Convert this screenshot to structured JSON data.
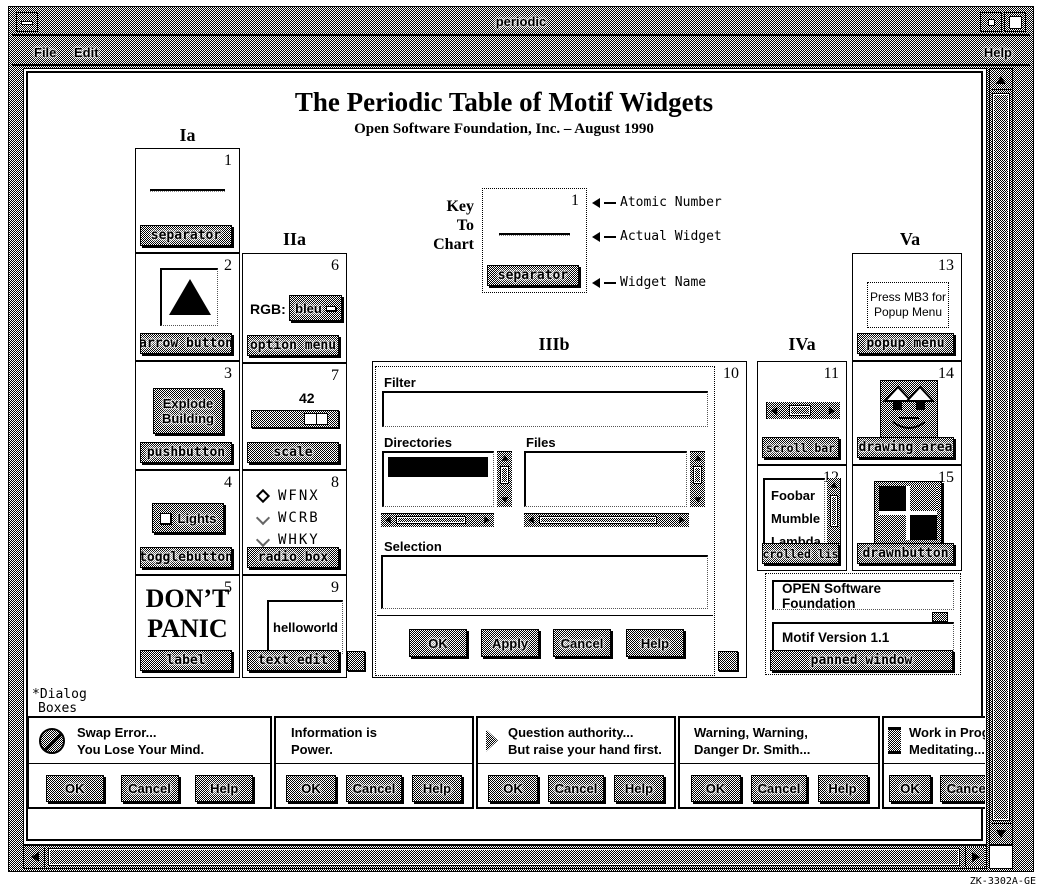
{
  "colors": {
    "foreground": "#000000",
    "background": "#ffffff"
  },
  "window": {
    "title": "periodic",
    "menus": {
      "file": "File",
      "edit": "Edit",
      "help": "Help"
    }
  },
  "header": {
    "title": "The Periodic Table of Motif Widgets",
    "subtitle": "Open Software Foundation, Inc. – August 1990"
  },
  "column_headers": {
    "ia": "Ia",
    "iia": "IIa",
    "iiib": "IIIb",
    "iva": "IVa",
    "va": "Va"
  },
  "key": {
    "label_line1": "Key",
    "label_line2": "To",
    "label_line3": "Chart",
    "number": "1",
    "widget_name": "separator",
    "annotations": {
      "number": "Atomic Number",
      "widget": "Actual Widget",
      "name": "Widget Name"
    }
  },
  "cells": {
    "separator": {
      "number": "1",
      "name": "separator"
    },
    "arrow_button": {
      "number": "2",
      "name": "arrow button"
    },
    "pushbutton": {
      "number": "3",
      "name": "pushbutton",
      "line1": "Explode",
      "line2": "Building"
    },
    "togglebutton": {
      "number": "4",
      "name": "togglebutton",
      "label": "Lights"
    },
    "label": {
      "number": "5",
      "name": "label",
      "line1": "DON’T",
      "line2": "PANIC"
    },
    "option_menu": {
      "number": "6",
      "name": "option menu",
      "label": "RGB:",
      "value": "bleu"
    },
    "scale": {
      "number": "7",
      "name": "scale",
      "value": "42"
    },
    "radio_box": {
      "number": "8",
      "name": "radio box",
      "options": [
        "WFNX",
        "WCRB",
        "WHKY"
      ]
    },
    "text_edit": {
      "number": "9",
      "name": "text edit",
      "text": "helloworld"
    },
    "file_selection": {
      "number": "10",
      "filter_label": "Filter",
      "directories_label": "Directories",
      "files_label": "Files",
      "selection_label": "Selection",
      "buttons": [
        "OK",
        "Apply",
        "Cancel",
        "Help"
      ]
    },
    "scroll_bar": {
      "number": "11",
      "name": "scroll bar"
    },
    "scrolled_list": {
      "number": "12",
      "name": "scrolled list",
      "items": [
        "Foobar",
        "Mumble",
        "Lambda"
      ]
    },
    "popup_menu": {
      "number": "13",
      "name": "popup menu",
      "line1": "Press MB3 for",
      "line2": "Popup Menu"
    },
    "drawing_area": {
      "number": "14",
      "name": "drawing area"
    },
    "drawnbutton": {
      "number": "15",
      "name": "drawnbutton"
    },
    "panned_window": {
      "name": "panned window",
      "pane1": "OPEN Software Foundation",
      "pane2": "Motif Version 1.1"
    }
  },
  "footnote": {
    "line1": "*Dialog",
    "line2": "Boxes"
  },
  "dialogs": [
    {
      "line1": "Swap Error...",
      "line2": "You Lose Your Mind.",
      "buttons": [
        "OK",
        "Cancel",
        "Help"
      ]
    },
    {
      "line1": "Information is",
      "line2": "Power.",
      "buttons": [
        "OK",
        "Cancel",
        "Help"
      ]
    },
    {
      "line1": "Question authority...",
      "line2": "But raise your hand first.",
      "buttons": [
        "OK",
        "Cancel",
        "Help"
      ]
    },
    {
      "line1": "Warning, Warning,",
      "line2": "Danger Dr. Smith...",
      "buttons": [
        "OK",
        "Cancel",
        "Help"
      ]
    },
    {
      "line1": "Work in Progress",
      "line2": "Meditating...",
      "buttons": [
        "OK",
        "Cancel"
      ]
    }
  ],
  "figure_id": "ZK-3302A-GE"
}
